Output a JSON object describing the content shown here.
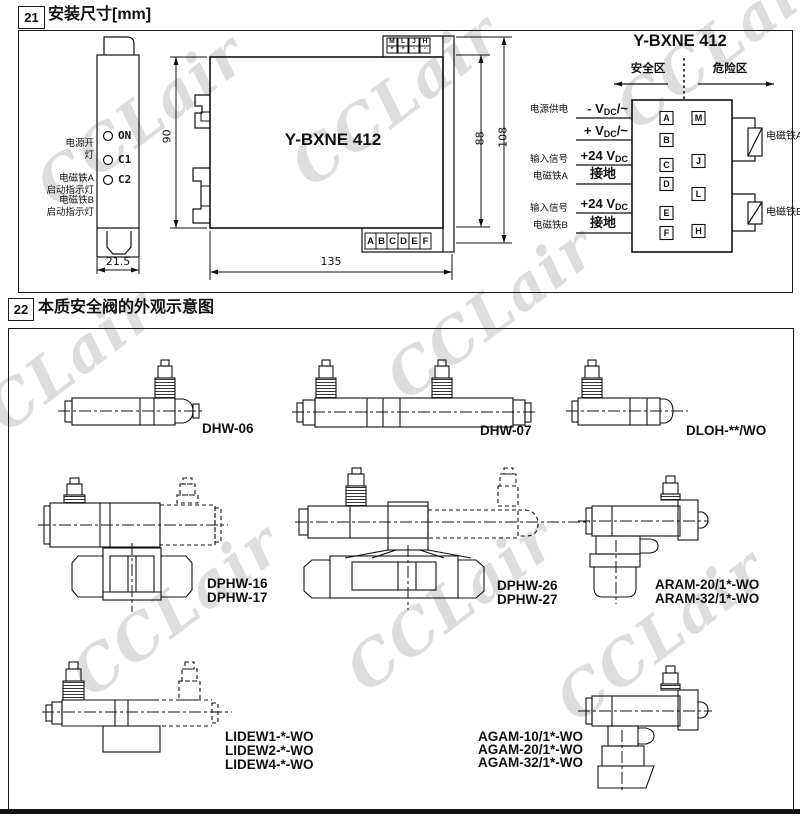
{
  "watermark": {
    "text": "CCLair"
  },
  "section21": {
    "number": "21",
    "title": "安装尺寸[mm]",
    "front_view": {
      "led_rows": [
        {
          "ann1": "电源开",
          "ann2": "灯",
          "label": "ON"
        },
        {
          "ann1": "电磁铁A",
          "ann2": "启动指示灯",
          "label": "C1"
        },
        {
          "ann1": "电磁铁B",
          "ann2": "启动指示灯",
          "label": "C2"
        }
      ],
      "dim_width": "21.5"
    },
    "side_view": {
      "model": "Y-BXNE 412",
      "dim_height": "90",
      "dim_length": "135",
      "dim_h1": "88",
      "dim_h2": "108",
      "top_terminals": [
        {
          "letter": "M",
          "sign": "+"
        },
        {
          "letter": "L",
          "sign": "+"
        },
        {
          "letter": "J",
          "sign": "-"
        },
        {
          "letter": "H",
          "sign": "-"
        }
      ],
      "bottom_terminals": [
        "A",
        "B",
        "C",
        "D",
        "E",
        "F"
      ]
    },
    "wiring": {
      "title": "Y-BXNE 412",
      "zone_left": "安全区",
      "zone_right": "危险区",
      "groups": [
        {
          "line1": "电源供电",
          "line2": ""
        },
        {
          "line1": "输入信号",
          "line2": "电磁铁A"
        },
        {
          "line1": "输入信号",
          "line2": "电磁铁B"
        }
      ],
      "signals": [
        {
          "pre": "- V",
          "sub": "DC",
          "post": "/~"
        },
        {
          "pre": "+ V",
          "sub": "DC",
          "post": "/~"
        },
        {
          "pre": "+24 V",
          "sub": "DC",
          "post": ""
        },
        {
          "pre": "接地",
          "sub": "",
          "post": ""
        },
        {
          "pre": "+24 V",
          "sub": "DC",
          "post": ""
        },
        {
          "pre": "接地",
          "sub": "",
          "post": ""
        }
      ],
      "left_terminals": [
        "A",
        "B",
        "C",
        "D",
        "E",
        "F"
      ],
      "right_terminals": [
        "M",
        "J",
        "L",
        "H"
      ],
      "solenoid_a": "电磁铁A",
      "solenoid_b": "电磁铁B"
    }
  },
  "section22": {
    "number": "22",
    "title": "本质安全阀的外观示意图",
    "labels": {
      "dhw06": "DHW-06",
      "dhw07": "DHW-07",
      "dloh": "DLOH-**/WO",
      "dphw16": "DPHW-16",
      "dphw17": "DPHW-17",
      "dphw26": "DPHW-26",
      "dphw27": "DPHW-27",
      "aram20": "ARAM-20/1*-WO",
      "aram32": "ARAM-32/1*-WO",
      "lidew1": "LIDEW1-*-WO",
      "lidew2": "LIDEW2-*-WO",
      "lidew4": "LIDEW4-*-WO",
      "agam10": "AGAM-10/1*-WO",
      "agam20": "AGAM-20/1*-WO",
      "agam32": "AGAM-32/1*-WO"
    }
  }
}
